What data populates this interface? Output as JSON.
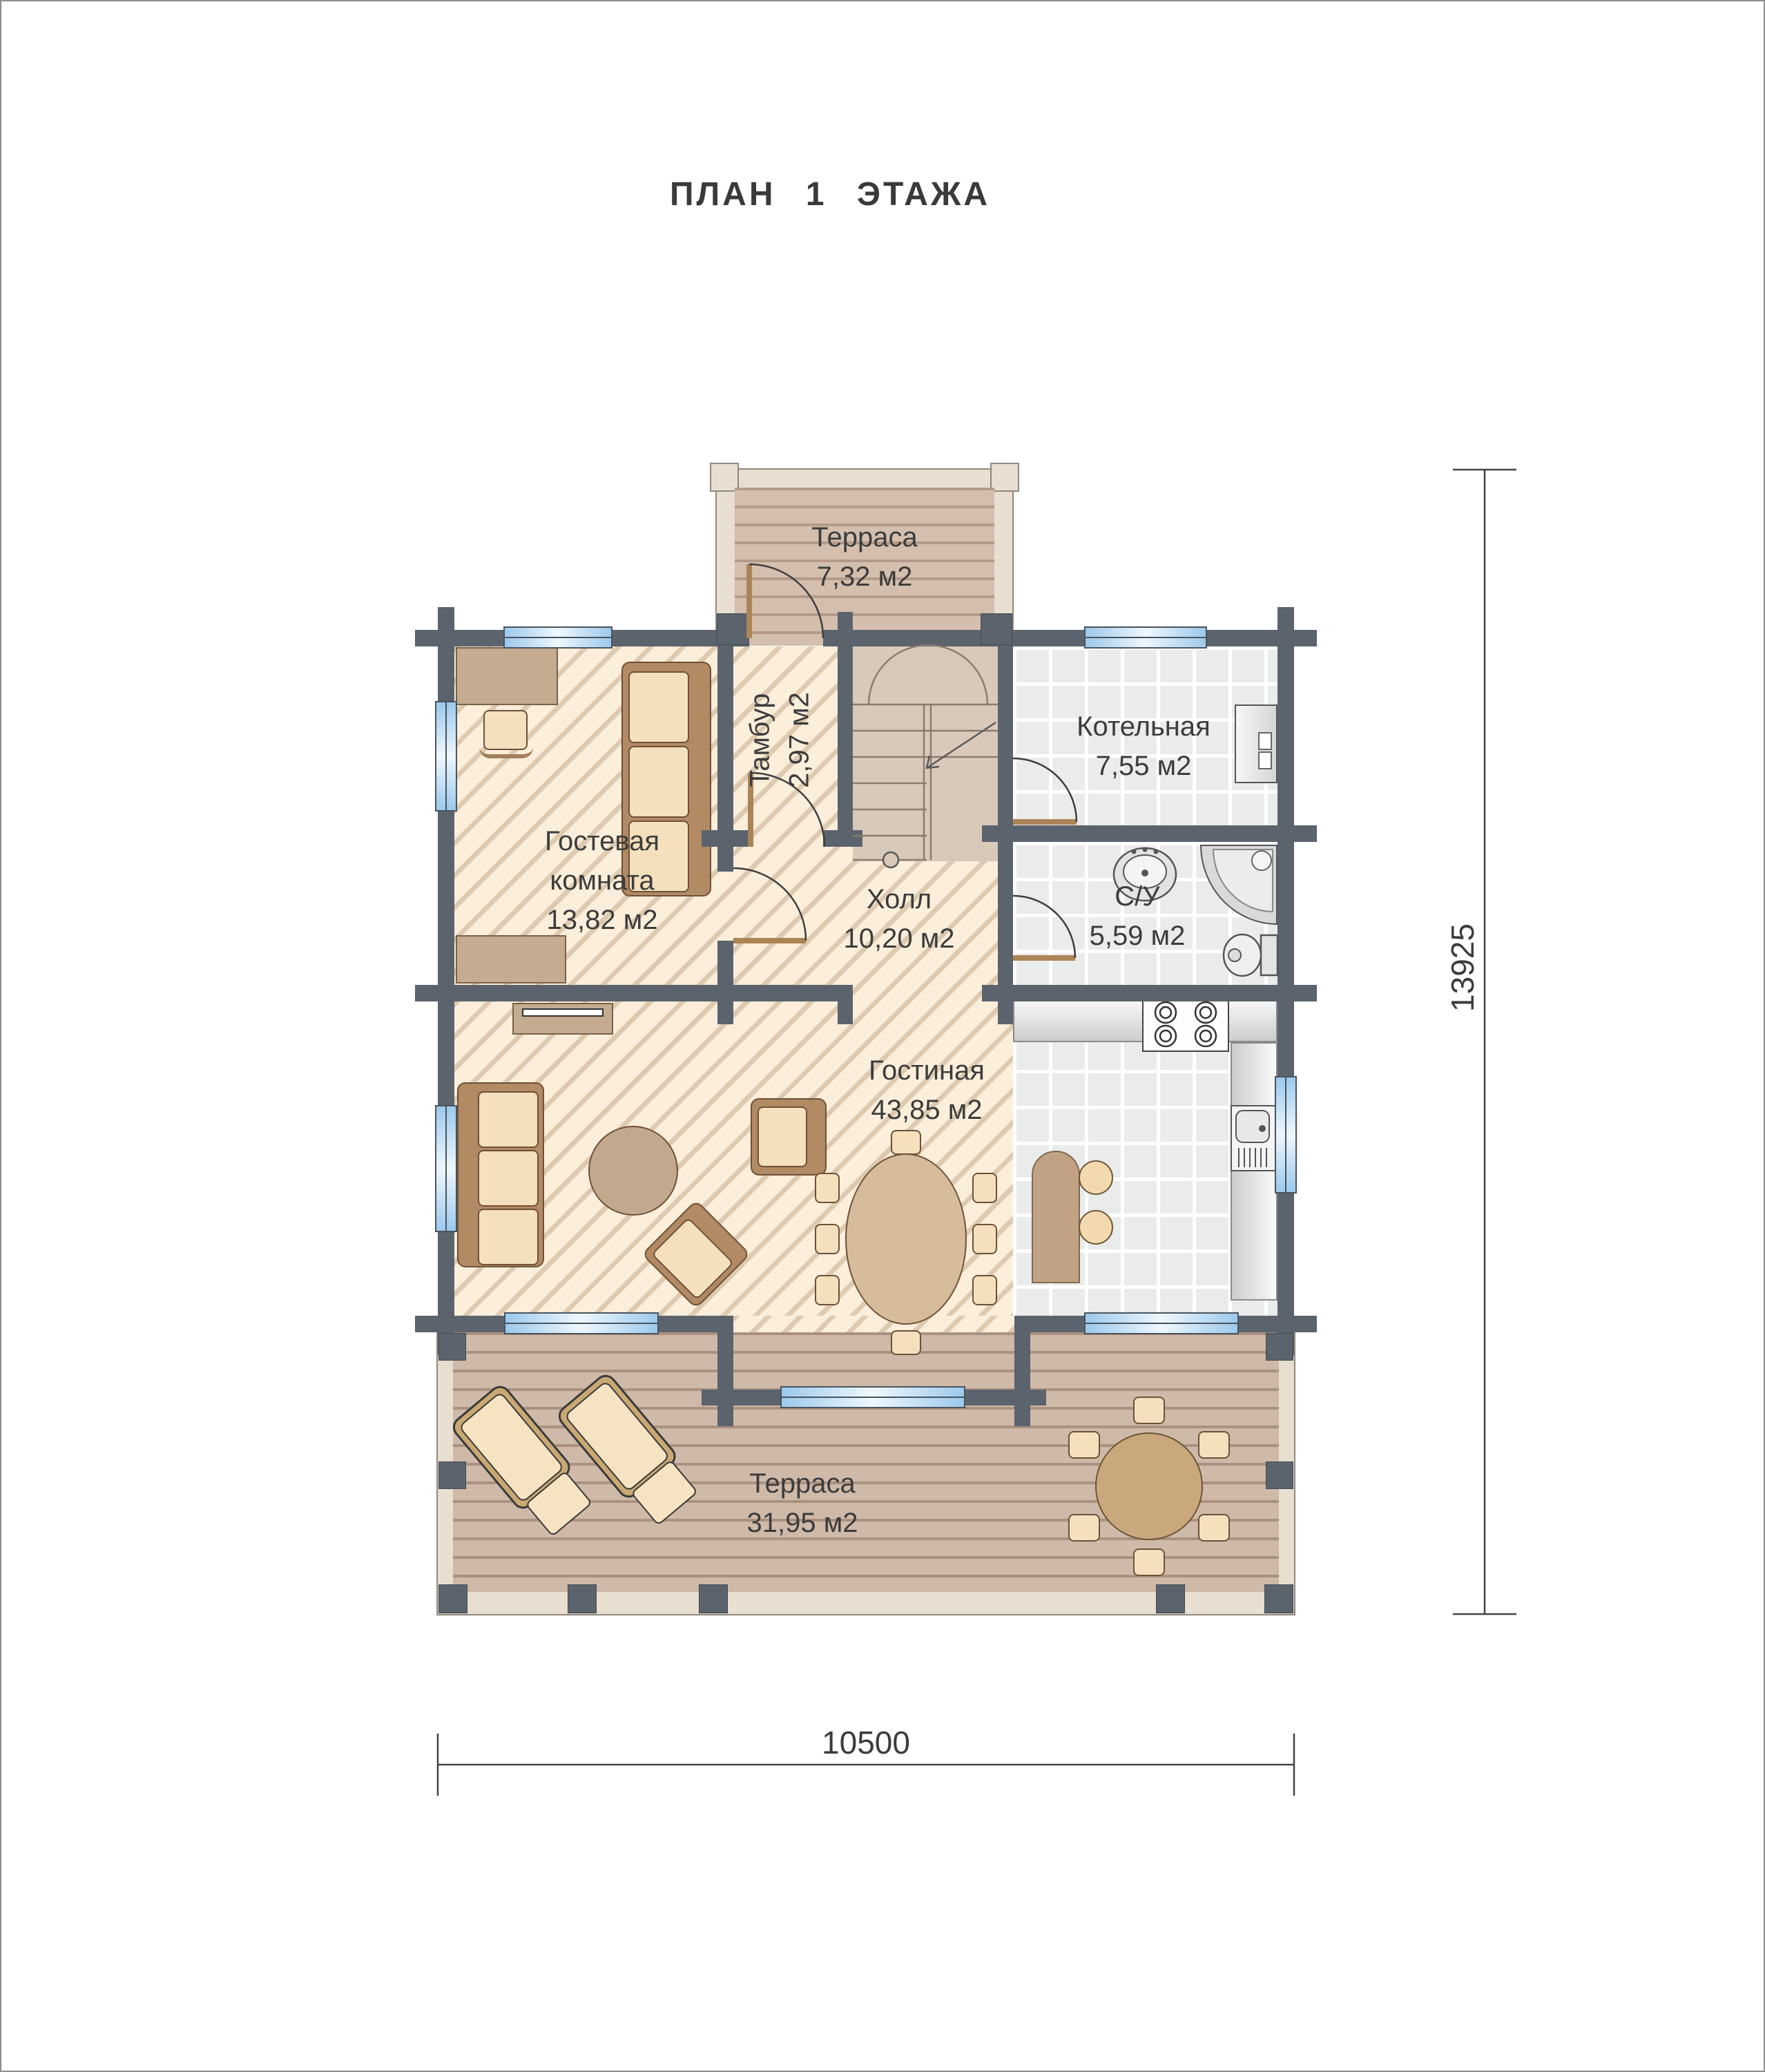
{
  "title": "ПЛАН 1 ЭТАЖА",
  "rooms": {
    "terrace_top": {
      "name": "Терраса",
      "area": "7,32 м2"
    },
    "tambour": {
      "name": "Тамбур",
      "area": "2,97 м2"
    },
    "boiler": {
      "name": "Котельная",
      "area": "7,55 м2"
    },
    "guest": {
      "name": "Гостевая",
      "name2": "комната",
      "area": "13,82 м2"
    },
    "hall": {
      "name": "Холл",
      "area": "10,20 м2"
    },
    "bathroom": {
      "name": "С/У",
      "area": "5,59 м2"
    },
    "living": {
      "name": "Гостиная",
      "area": "43,85 м2"
    },
    "terrace_bottom": {
      "name": "Терраса",
      "area": "31,95 м2"
    }
  },
  "dimensions": {
    "height_mm": "13925",
    "width_mm": "10500"
  },
  "colors": {
    "wall": "#5b636d",
    "window": "#9cc9ec",
    "floor": "#fbeeda",
    "deck": "#cfb9a8"
  }
}
